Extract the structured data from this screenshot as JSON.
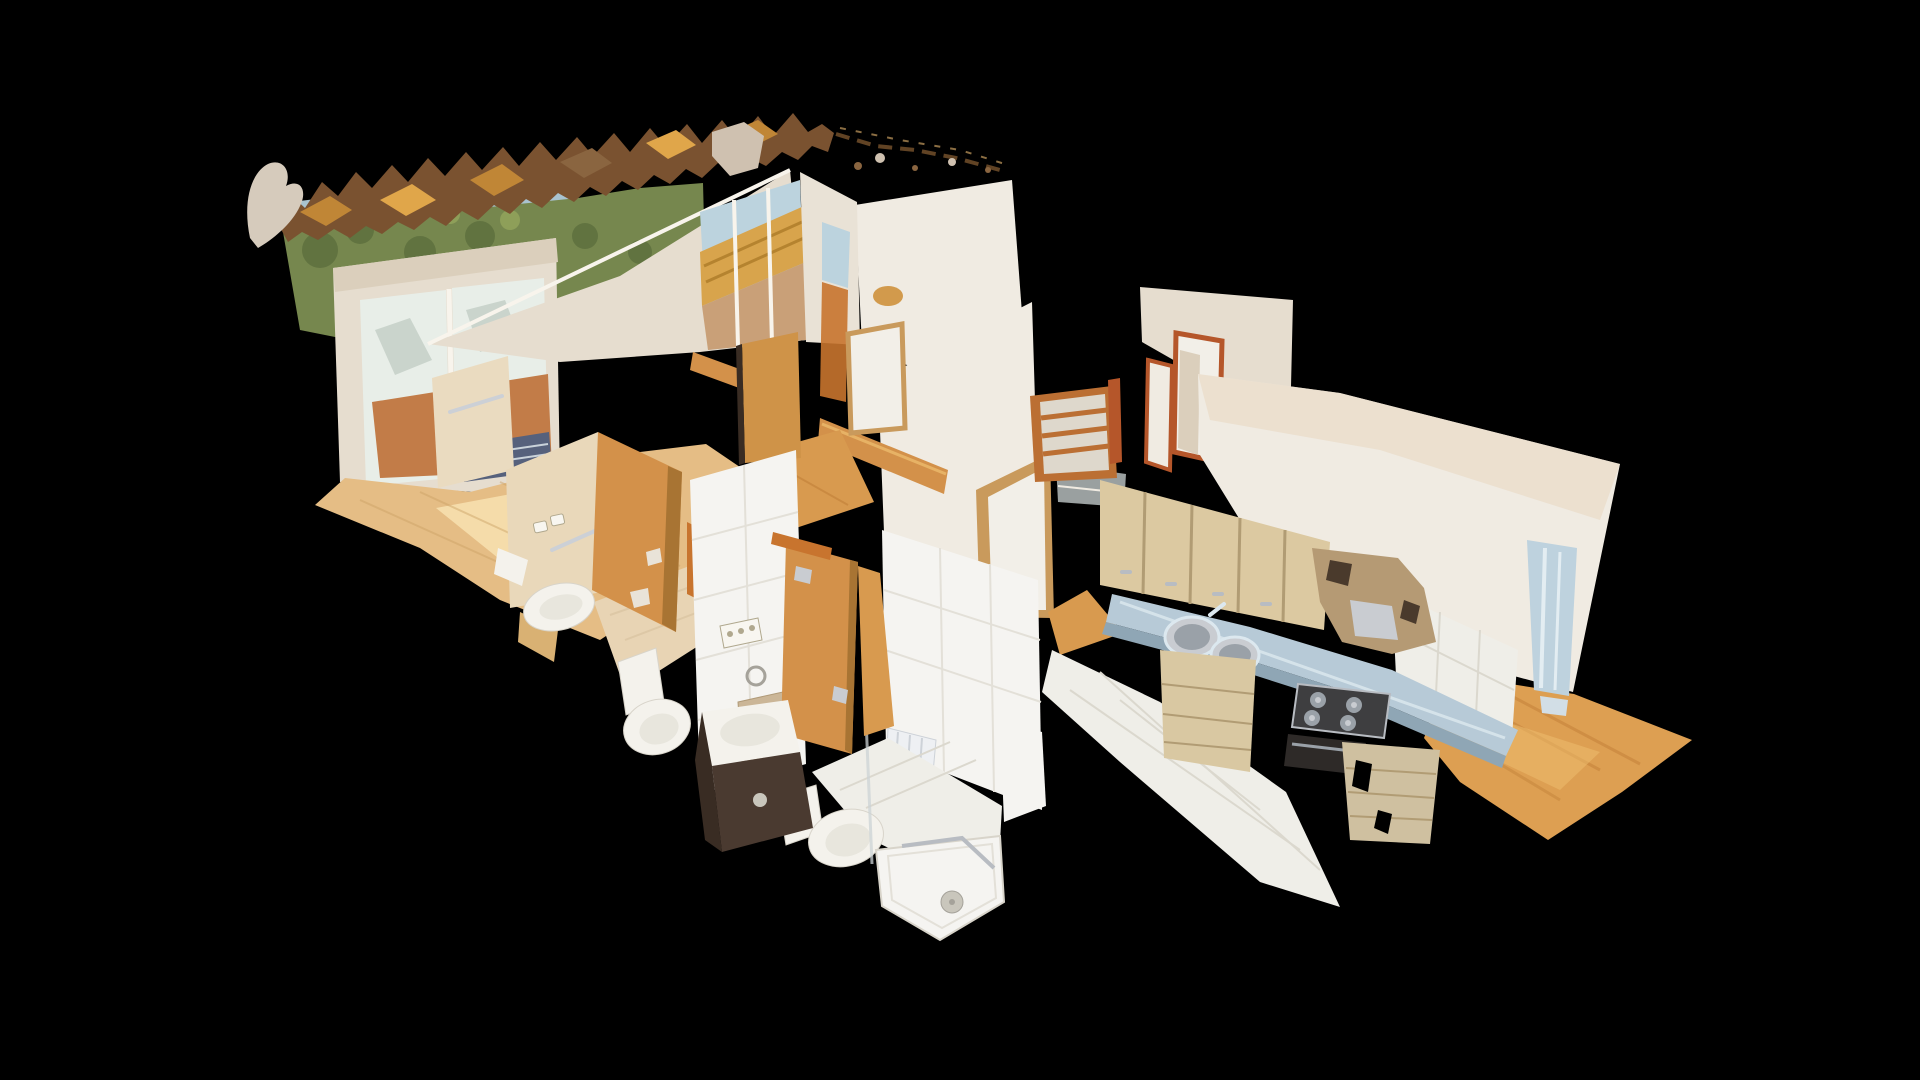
{
  "app": {
    "name": "3d-dollhouse-viewer",
    "view_mode": "dollhouse-cutaway",
    "background": "#000000"
  },
  "scene": {
    "type": "textured-3d-scan",
    "subject": "apartment interior, top-down oblique cutaway on black background",
    "rooms": [
      {
        "name": "balcony",
        "features": [
          "terracotta tile floor",
          "glass doors",
          "trees and building visible outside"
        ]
      },
      {
        "name": "living-room",
        "features": [
          "light oak floor",
          "double balcony doors",
          "corner bay window with awning"
        ]
      },
      {
        "name": "hallway",
        "features": [
          "oak strip floor",
          "wooden doors",
          "half wall with wood cap",
          "ladder radiator"
        ]
      },
      {
        "name": "bathroom-1",
        "features": [
          "beige tile floor",
          "bidet",
          "toilet",
          "towel rails",
          "wall sockets",
          "wooden door"
        ]
      },
      {
        "name": "bathroom-2",
        "features": [
          "white tile walls",
          "dark vanity with white basin",
          "toilet",
          "shower tray with drain",
          "glass screen",
          "small radiator",
          "wooden door"
        ]
      },
      {
        "name": "kitchen",
        "features": [
          "light wood upper and lower cabinets",
          "blue-grey countertop",
          "double round sink",
          "gas hob",
          "oven",
          "torn extractor hood",
          "white tile floor",
          "tile backsplash",
          "wall socket"
        ]
      },
      {
        "name": "bedroom",
        "features": [
          "oak floor",
          "wall-mounted radiator strip"
        ]
      }
    ],
    "artifacts": [
      "ragged roof debris band",
      "mesh holes",
      "floating shards"
    ]
  },
  "palette": {
    "bg": "#000000",
    "sky": "#a9c3cf",
    "trees": "#76874e",
    "treesDark": "#5d6e3d",
    "treesLight": "#93a35c",
    "building": "#b98c83",
    "debris": "#7a5230",
    "debrisAmber": "#e0a64a",
    "debrisGold": "#c08636",
    "debrisUmber": "#8a6540",
    "debrisLine": "#6b4a28",
    "debrisLine2": "#9a7a4a",
    "shard": "#d6cbbc",
    "shard2": "#cfc1b0",
    "wall": "#f0ebe2",
    "wallShade": "#e6ddcf",
    "wallWarm": "#e9dcc8",
    "wallDim": "#dbcfbc",
    "wallCol": "#e9e2d6",
    "beigeWall": "#e9d8ba",
    "beigeWall2": "#eadbc0",
    "tileWall": "#f5f4f1",
    "tileGrid": "#e3e0d8",
    "tileFloorWhite": "#efeee8",
    "tileFloorGrid": "#dbd8ce",
    "beigeTileFloor": "#e8d4b4",
    "beigeTileGrid": "#d6c09c",
    "woodFloor": "#e5bd85",
    "woodFloorLight": "#f6dfae",
    "woodFloorLine": "#caa064",
    "hallWood": "#d89a4f",
    "oakFloor": "#dd9f52",
    "oakLine": "#c28038",
    "oakLight": "#f0c070",
    "terracotta": "#c27c48",
    "terrShade": "#56617c",
    "terrSlat": "#c9d2da",
    "doorWood": "#d3914a",
    "doorWoodDark": "#a87433",
    "doorWood2": "#cf9348",
    "trimOrange": "#c8742e",
    "trimRed": "#b5562a",
    "frameWood": "#c99a5c",
    "doorLeaf": "#f2efe8",
    "glass": "#e8eee8",
    "glassShadow": "#c2cdc4",
    "bayGlass": "#bcd3de",
    "awning": "#d8a44c",
    "awningLine": "#b5832f",
    "street": "#c9a078",
    "cabinet": "#dcc9a1",
    "cabinetLine": "#b19c74",
    "cabinetLow": "#d9c8a2",
    "cabinetLow2": "#cfc0a0",
    "counter": "#b7cad7",
    "counterEdge": "#8fa6b5",
    "counterSheen": "#dce8ef",
    "steel": "#c9ccd1",
    "steelDark": "#9aa1a8",
    "steelMid": "#b8bcc2",
    "hood": "#b59a74",
    "hoodTear": "#4a3a2c",
    "hob": "#3e3e40",
    "oven": "#2e2a28",
    "fixture": "#f4f2ec",
    "fixtureRim": "#e8e6dd",
    "fixtureLine": "#d8d4ca",
    "vanity": "#4a3a30",
    "vanitySide": "#392c23",
    "vanityWood": "#d9b173",
    "chrome": "#ccd3d6",
    "rail": "#ccd0d6",
    "socket": "#f8f6f0",
    "socketLine": "#b0a88e",
    "niche": "#cbb697",
    "nicheLine": "#b09a78",
    "drain": "#c9c6bc",
    "drainRing": "#a5a29a",
    "radStrip": "#bed2de",
    "radStripLight": "#e3edf2",
    "radFoot": "#d2dee6",
    "radWhite": "#eef0f3",
    "radLine": "#cdd2d8",
    "grayCab": "#9aa0a0",
    "ladder": "#bb6f33",
    "ladderSlat": "#ded8cc",
    "scratch": "#7a6a58",
    "blotch": "#d29a4c",
    "scuff": "#e9e3d8",
    "wallEdge": "#f8f4ec"
  }
}
